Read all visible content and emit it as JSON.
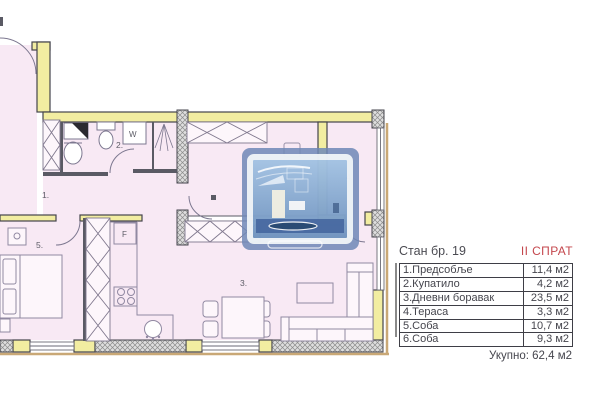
{
  "info_panel": {
    "title": "Стан бр. 19",
    "floor": "II СПРАТ",
    "accent_color": "#c4474d",
    "rows": [
      {
        "name": "1.Предсобље",
        "value": "11,4 м2"
      },
      {
        "name": "2.Купатило",
        "value": "4,2 м2"
      },
      {
        "name": "3.Дневни боравак",
        "value": "23,5 м2"
      },
      {
        "name": "4.Тераса",
        "value": "3,3 м2"
      },
      {
        "name": "5.Соба",
        "value": "10,7 м2"
      },
      {
        "name": "6.Соба",
        "value": "9,3 м2"
      }
    ],
    "total": "Укупно: 62,4 м2"
  },
  "plan": {
    "room_labels": {
      "hall": "1.",
      "bathroom": "2.",
      "living": "3.",
      "terrace": "4.",
      "bedroom": "5."
    },
    "appliance_labels": {
      "washer": "W",
      "fridge": "F"
    },
    "colors": {
      "floor": "#f8e9f4",
      "wall_fill": "#f2eda1",
      "outline": "#44444c",
      "furniture": "#9189a2",
      "slab_line": "#c9a876",
      "watermark_blue": "#6e87b6"
    }
  }
}
